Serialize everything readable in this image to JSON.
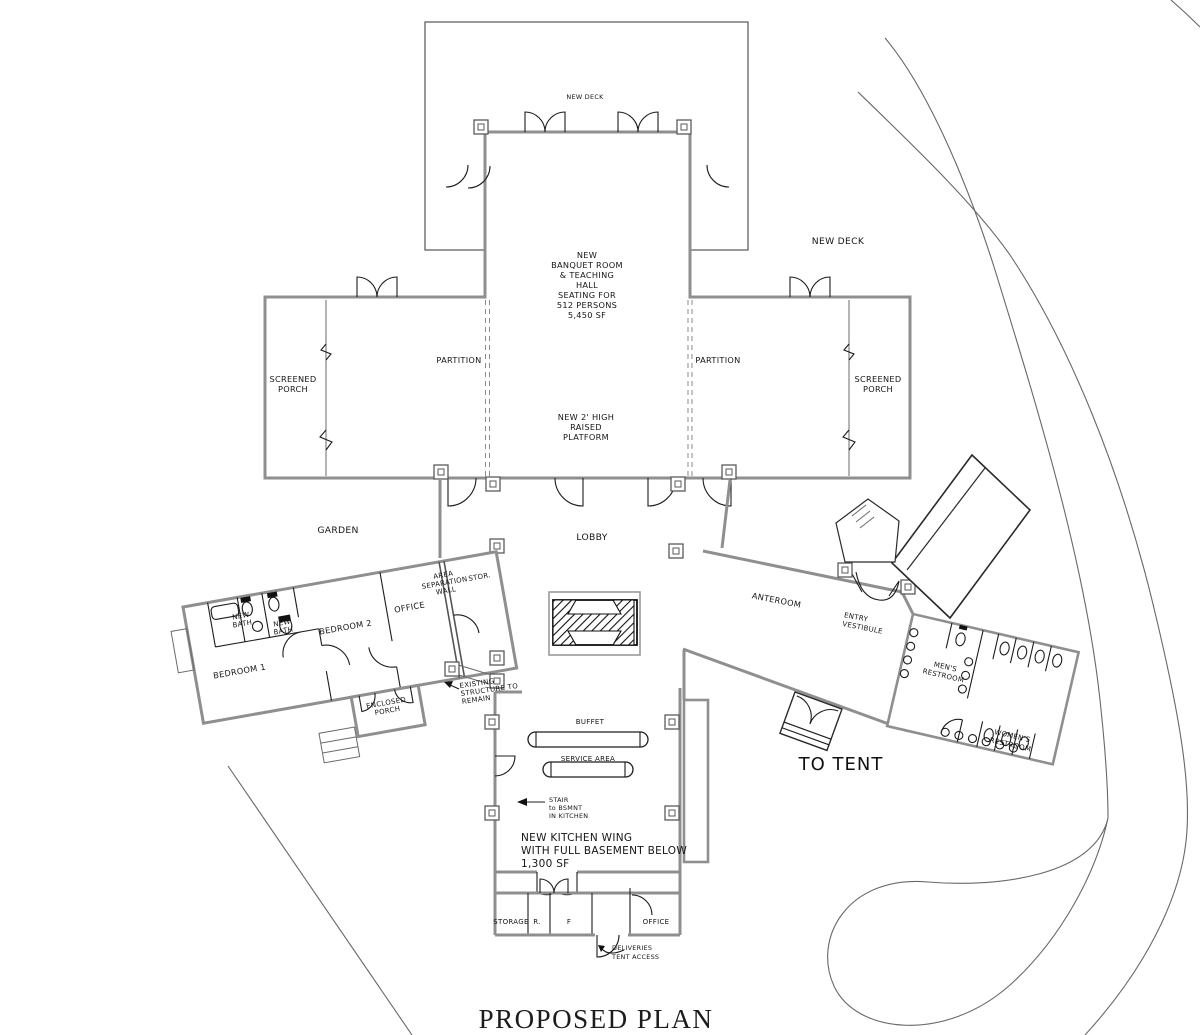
{
  "title": "PROPOSED PLAN",
  "colors": {
    "wall": "#8f8f8f",
    "detail": "#1c1c1c",
    "site_line": "#686868",
    "text": "#151515",
    "background": "#ffffff"
  },
  "labels": {
    "deck_top": "NEW DECK",
    "deck_right": "NEW DECK",
    "banquet": [
      "NEW",
      "BANQUET ROOM",
      "& TEACHING",
      "HALL",
      "SEATING FOR",
      "512 PERSONS",
      "5,450 SF"
    ],
    "partition_left": "PARTITION",
    "partition_right": "PARTITION",
    "screened_porch_left": [
      "SCREENED",
      "PORCH"
    ],
    "screened_porch_right": [
      "SCREENED",
      "PORCH"
    ],
    "platform": [
      "NEW 2' HIGH",
      "RAISED",
      "PLATFORM"
    ],
    "garden": "GARDEN",
    "lobby": "LOBBY",
    "area_separation_wall": [
      "AREA",
      "SEPARATION",
      "WALL"
    ],
    "stor": "STOR.",
    "wing_office": "OFFICE",
    "bedroom_2": "BEDROOM 2",
    "new_bath_1": [
      "NEW",
      "BATH"
    ],
    "new_bath_2": [
      "NEW",
      "BATH"
    ],
    "bedroom_1": "BEDROOM 1",
    "enclosed_porch": [
      "ENCLOSED",
      "PORCH"
    ],
    "existing_structure": [
      "EXISTING",
      "STRUCTURE TO",
      "REMAIN"
    ],
    "anteroom": "ANTEROOM",
    "entry_vestibule": [
      "ENTRY",
      "VESTIBULE"
    ],
    "mens_restroom": [
      "MEN'S",
      "RESTROOM"
    ],
    "womens_restroom": [
      "WOMEN'S",
      "RESTROOM"
    ],
    "to_tent": "TO TENT",
    "buffet": "BUFFET",
    "service_area": "SERVICE AREA",
    "stair": [
      "STAIR",
      "to BSMNT",
      "IN KITCHEN"
    ],
    "kitchen_wing": [
      "NEW KITCHEN WING",
      "WITH FULL BASEMENT BELOW",
      "1,300 SF"
    ],
    "storage": "STORAGE",
    "refrigerator": "R.",
    "freezer": "F",
    "kitchen_office": "OFFICE",
    "deliveries": [
      "DELIVERIES",
      "TENT ACCESS"
    ]
  }
}
